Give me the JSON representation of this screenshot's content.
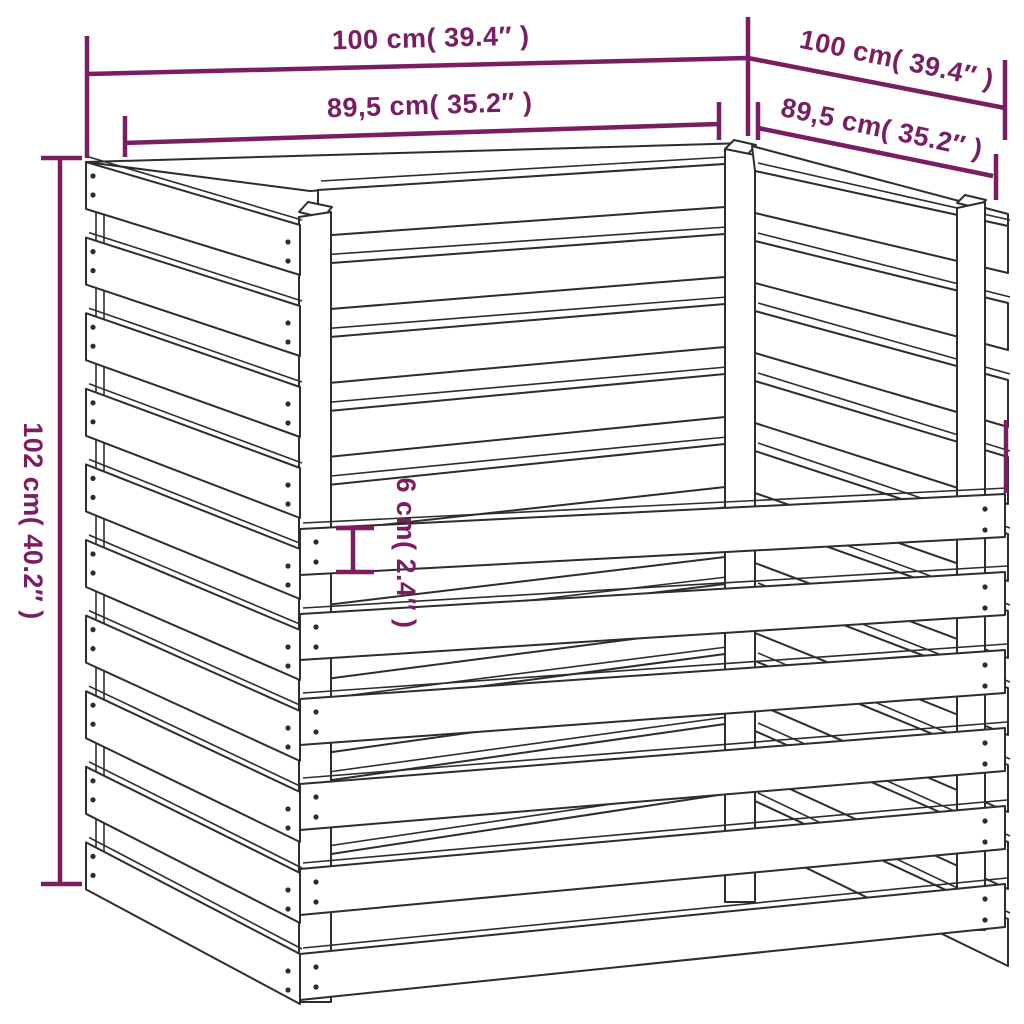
{
  "canvas": {
    "background": "#ffffff",
    "stroke_color": "#2d2d2d",
    "dimension_color": "#7A1E62"
  },
  "annotations": {
    "top_width": "100 cm( 39.4″ )",
    "top_depth": "100 cm( 39.4″ )",
    "inner_width": "89,5 cm( 35.2″ )",
    "inner_depth": "89,5 cm( 35.2″ )",
    "height": "102 cm( 40.2″ )",
    "board_width": "6 cm( 2.4″ )"
  }
}
